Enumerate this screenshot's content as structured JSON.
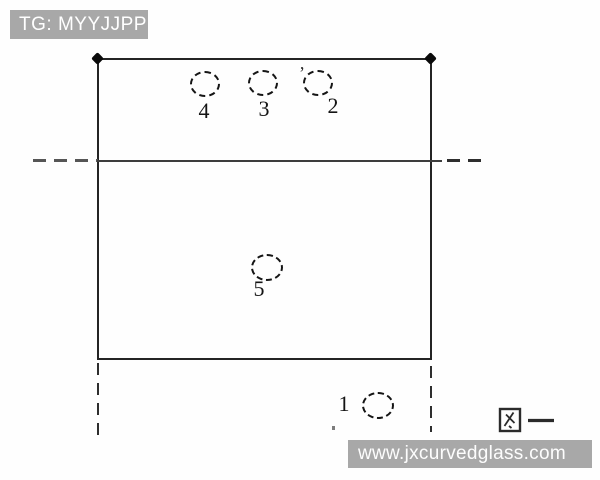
{
  "watermarks": {
    "tag": "TG: MYYJJPP",
    "website": "www.jxcurvedglass.com"
  },
  "figure": {
    "caption": "图一",
    "caption_meaning": "Figure 1",
    "hole_labels": {
      "hole1": "1",
      "hole2": "2",
      "hole3": "3",
      "hole4": "4",
      "hole5": "5"
    }
  },
  "colors": {
    "watermark_bg": "#a8a8a8",
    "watermark_text": "#ffffff",
    "line_color": "#2e2e2e",
    "background": "#fefefe"
  }
}
